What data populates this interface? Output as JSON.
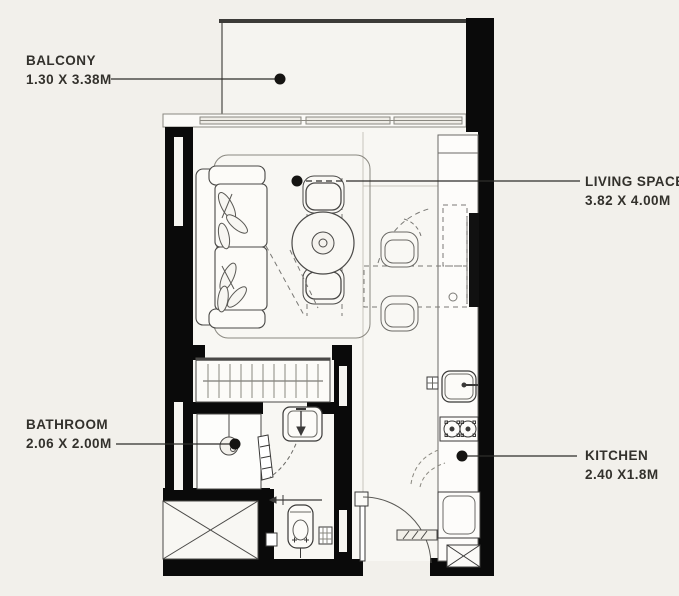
{
  "plan": {
    "type": "apartment-floor-plan",
    "rooms": [
      {
        "id": "balcony",
        "label": "BALCONY",
        "dimensions": "1.30 X 3.38M"
      },
      {
        "id": "living_space",
        "label": "LIVING SPACE",
        "dimensions": "3.82 X 4.00M"
      },
      {
        "id": "bathroom",
        "label": "BATHROOM",
        "dimensions": "2.06 X 2.00M"
      },
      {
        "id": "kitchen",
        "label": "KITCHEN",
        "dimensions": "2.40 X1.8M"
      }
    ],
    "fixtures": {
      "living_space": [
        "sofa",
        "area-rug",
        "round-dining-table",
        "dining-chairs",
        "wall-tv",
        "fold-down-table"
      ],
      "kitchen": [
        "kitchen-counter",
        "kitchen-sink",
        "stove-two-burners",
        "fridge",
        "service-shaft"
      ],
      "bathroom": [
        "shower",
        "wash-basin",
        "toilet",
        "floor-drain"
      ],
      "other": [
        "wardrobe-with-hangers",
        "entry-door",
        "bathroom-door",
        "service-shaft",
        "window-band",
        "balcony-rail"
      ]
    },
    "colors": {
      "background": "#f2f0eb",
      "walls": "#0a0a0a",
      "floor": "#f8f7f3",
      "line": "#4a4947",
      "text": "#33312c",
      "leader_dot": "#151412"
    }
  }
}
